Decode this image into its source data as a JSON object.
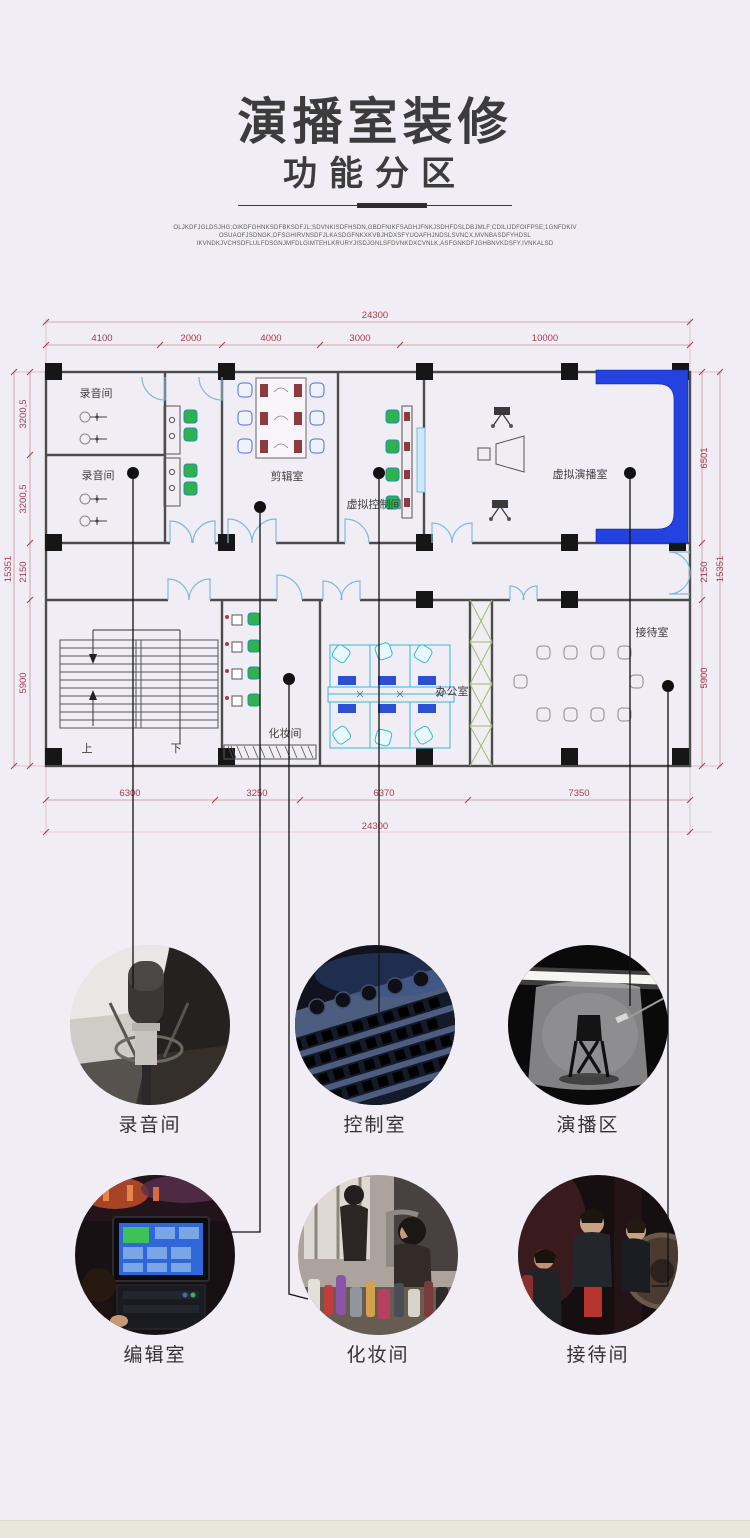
{
  "page": {
    "title": "演播室装修",
    "subtitle": "功能分区",
    "filler_lines": [
      "OLJKDFJGLDSJHG;OIKDFGHNKSDFBKSDFJL;SDVNKISDFHSDN,GBDFNIKFSADHJFNKJSDHFDSLDBJMLF;CDILIJDFOIFPSE;1GNFDKIV",
      "OSUAOFJSDNGK,DFSGHIRVNSDFJLKASDGFNKXKVBJHDXSFYUOAFHJNDSLSVNCX,MVNBASDFYHDSL",
      "IKVNDKJVCHSDFLULFDSGNJMFDLGIMTEHLKRURYJISDJGNLSFDVNKDXCVNLK,ASFGNKDFJGHBNVKDSFY,IVNKALSD"
    ],
    "background": "#f0eef4"
  },
  "plan": {
    "rooms": {
      "recording1": "录音间",
      "recording2": "录音间",
      "editing": "剪辑室",
      "virtual_control": "虚拟控制间",
      "virtual_studio": "虚拟演播室",
      "makeup": "化妆间",
      "office": "办公室",
      "reception": "接待室",
      "stairs_up": "上",
      "stairs_down": "下"
    },
    "dims": {
      "top_total": "24300",
      "top_segments": [
        "4100",
        "2000",
        "4000",
        "3000",
        "10000"
      ],
      "bottom_segments": [
        "6300",
        "3250",
        "6370",
        "7350"
      ],
      "bottom_total": "24300",
      "left_segments": [
        "3200,5",
        "3200,5",
        "2150",
        "5900"
      ],
      "left_total": "15351",
      "right_segments": [
        "6501",
        "2150",
        "5900"
      ],
      "right_total": "15351"
    },
    "colors": {
      "dimension": "#a93a4c",
      "wall": "#4c4c4c",
      "column": "#161616",
      "door_blue": "#7fb9dd",
      "chair_green": "#2fb14b",
      "chair_blue": "#4f6fd8",
      "desk_cyan": "#35b9d6",
      "monitor_maroon": "#8e3b3f",
      "cyclorama_blue": "#2342df",
      "lattice_green": "#9fbf6a"
    }
  },
  "gallery": {
    "items": [
      {
        "label": "录音间"
      },
      {
        "label": "控制室"
      },
      {
        "label": "演播区"
      },
      {
        "label": "编辑室"
      },
      {
        "label": "化妆间"
      },
      {
        "label": "接待间"
      }
    ]
  }
}
